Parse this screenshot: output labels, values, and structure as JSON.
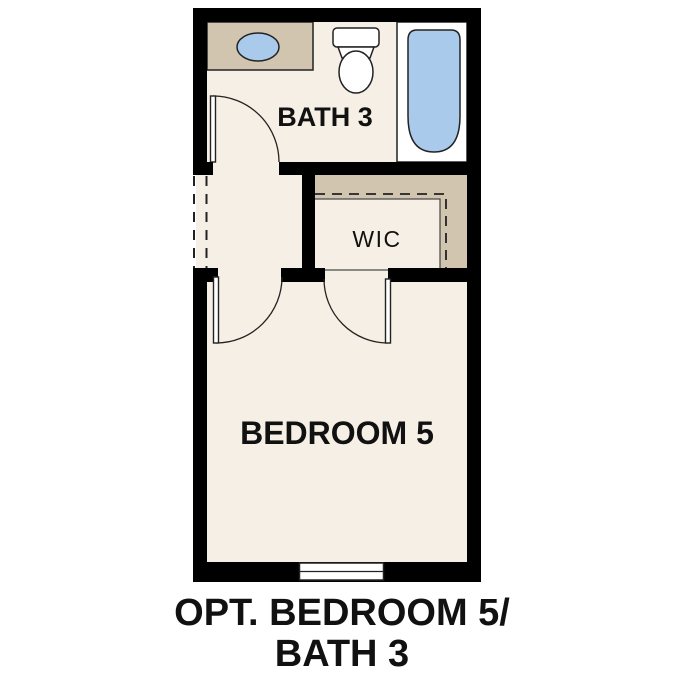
{
  "colors": {
    "background": "#ffffff",
    "wall": "#000000",
    "floor": "#f6efe5",
    "counter_tan": "#d1c5b0",
    "fixture_blue": "#aacaec",
    "surround_white": "#ffffff",
    "outline": "#222222",
    "label_text": "#111111"
  },
  "rooms": {
    "bath": {
      "label": "BATH 3"
    },
    "wic": {
      "label": "WIC"
    },
    "bedroom": {
      "label": "BEDROOM 5"
    }
  },
  "caption": {
    "line1": "OPT. BEDROOM 5/",
    "line2": "BATH 3"
  },
  "fixtures": {
    "sink": "sink-basin-icon",
    "toilet": "toilet-icon",
    "bathtub": "bathtub-icon",
    "vanity": "vanity-counter",
    "window": "window-icon",
    "bath_door": "door-swing-icon",
    "bedroom_door": "door-swing-icon",
    "wic_door": "door-swing-icon",
    "shelving": "closet-shelf-dashes"
  }
}
